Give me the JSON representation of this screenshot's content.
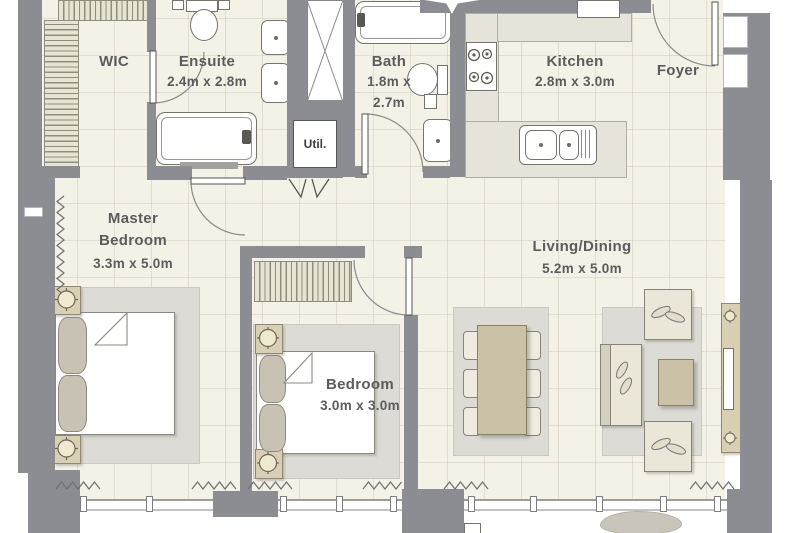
{
  "plan": {
    "type": "apartment-floor-plan",
    "rooms": {
      "wic": {
        "name": "WIC"
      },
      "ensuite": {
        "name": "Ensuite",
        "dimensions": "2.4m x 2.8m"
      },
      "bath": {
        "name": "Bath",
        "dimensions_line1": "1.8m x",
        "dimensions_line2": "2.7m"
      },
      "util": {
        "name": "Util."
      },
      "kitchen": {
        "name": "Kitchen",
        "dimensions": "2.8m x 3.0m"
      },
      "foyer": {
        "name": "Foyer"
      },
      "master_bedroom": {
        "name_line1": "Master",
        "name_line2": "Bedroom",
        "dimensions": "3.3m x 5.0m"
      },
      "bedroom": {
        "name": "Bedroom",
        "dimensions": "3.0m x 3.0m"
      },
      "living_dining": {
        "name": "Living/Dining",
        "dimensions": "5.2m x 5.0m"
      }
    },
    "colors": {
      "wall": "#8c8c93",
      "floor": "#f4f1e7",
      "rug": "#dcdbd5",
      "furniture_beige": "#cfc5ab",
      "fixture_white": "#ffffff",
      "label_text": "#5c5c5e"
    },
    "icons": {
      "door-swing-icon": "quarter-circle-arc",
      "lamp-icon": "circle-with-cross",
      "curtain-icon": "zigzag-line",
      "duct-shaft-icon": "box-with-x",
      "compass-star-icon": "four-point-star",
      "burner-icon": "circle",
      "window-mullion-icon": "small-rect"
    }
  }
}
